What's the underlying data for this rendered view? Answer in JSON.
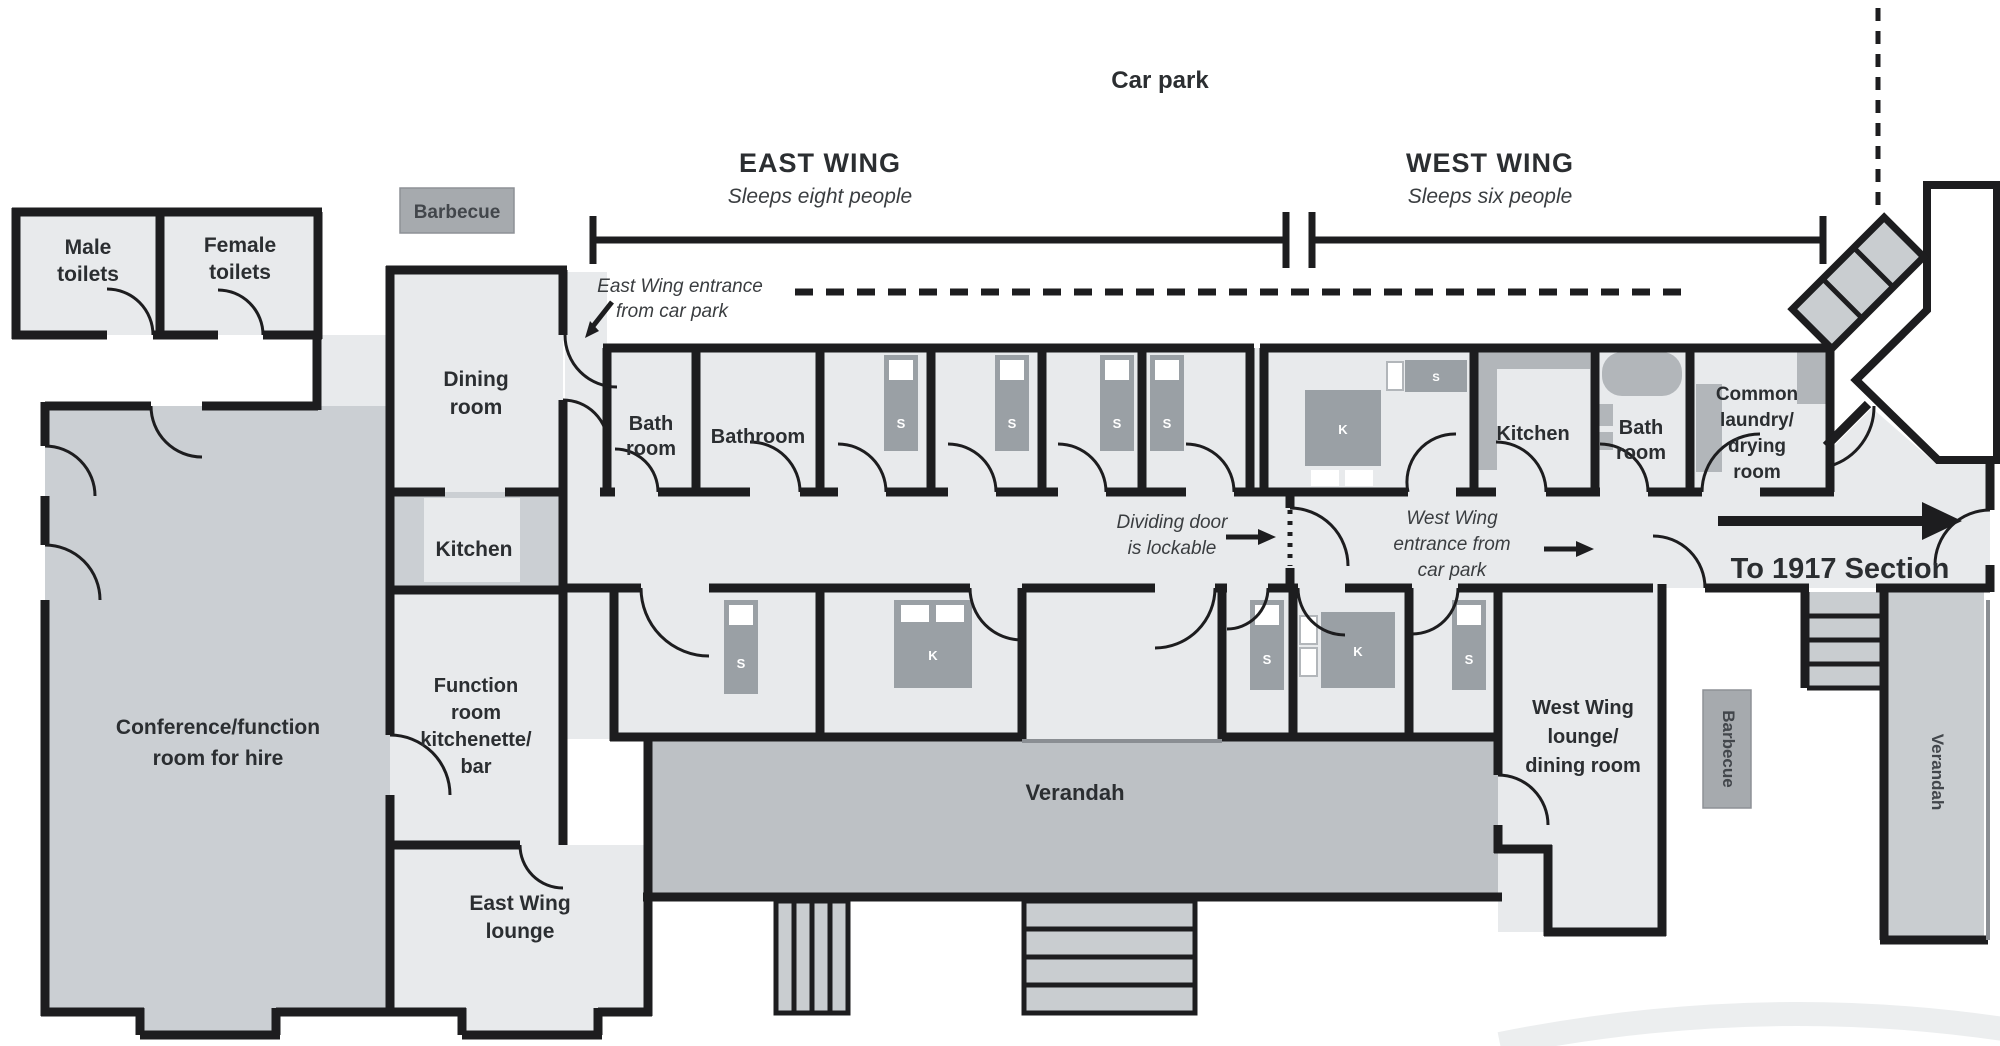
{
  "site": {
    "car_park": "Car park"
  },
  "wings": {
    "east": {
      "title": "EAST WING",
      "subtitle": "Sleeps eight people"
    },
    "west": {
      "title": "WEST WING",
      "subtitle": "Sleeps six people"
    }
  },
  "annotations": {
    "east_entrance": [
      "East Wing entrance",
      "from car park"
    ],
    "dividing_door": [
      "Dividing door",
      "is lockable"
    ],
    "west_entrance": [
      "West Wing",
      "entrance from",
      "car park"
    ],
    "to_1917": "To 1917 Section"
  },
  "rooms": {
    "male_toilets": [
      "Male",
      "toilets"
    ],
    "female_toilets": [
      "Female",
      "toilets"
    ],
    "dining": [
      "Dining",
      "room"
    ],
    "kitchen_main": "Kitchen",
    "function_room": [
      "Function",
      "room",
      "kitchenette/",
      "bar"
    ],
    "conference": [
      "Conference/function",
      "room for hire"
    ],
    "east_lounge": [
      "East Wing",
      "lounge"
    ],
    "bath_room_east": [
      "Bath",
      "room"
    ],
    "bathroom_east": "Bathroom",
    "kitchen_west": "Kitchen",
    "bath_room_west": [
      "Bath",
      "room"
    ],
    "common_laundry": [
      "Common",
      "laundry/",
      "drying",
      "room"
    ],
    "west_lounge": [
      "West Wing",
      "lounge/",
      "dining room"
    ],
    "verandah_main": "Verandah",
    "verandah_side": "Verandah"
  },
  "outdoor": {
    "barbecue_top": "Barbecue",
    "barbecue_side": "Barbecue"
  },
  "beds": {
    "single": "S",
    "king": "K"
  },
  "colors": {
    "wall": "#1d1d1f",
    "floor_light": "#e8eaec",
    "floor_mid": "#cbcfd3",
    "verandah": "#bdc1c5",
    "furniture": "#9aa0a5",
    "label_box": "#a6aaae",
    "text": "#2b2e31"
  }
}
